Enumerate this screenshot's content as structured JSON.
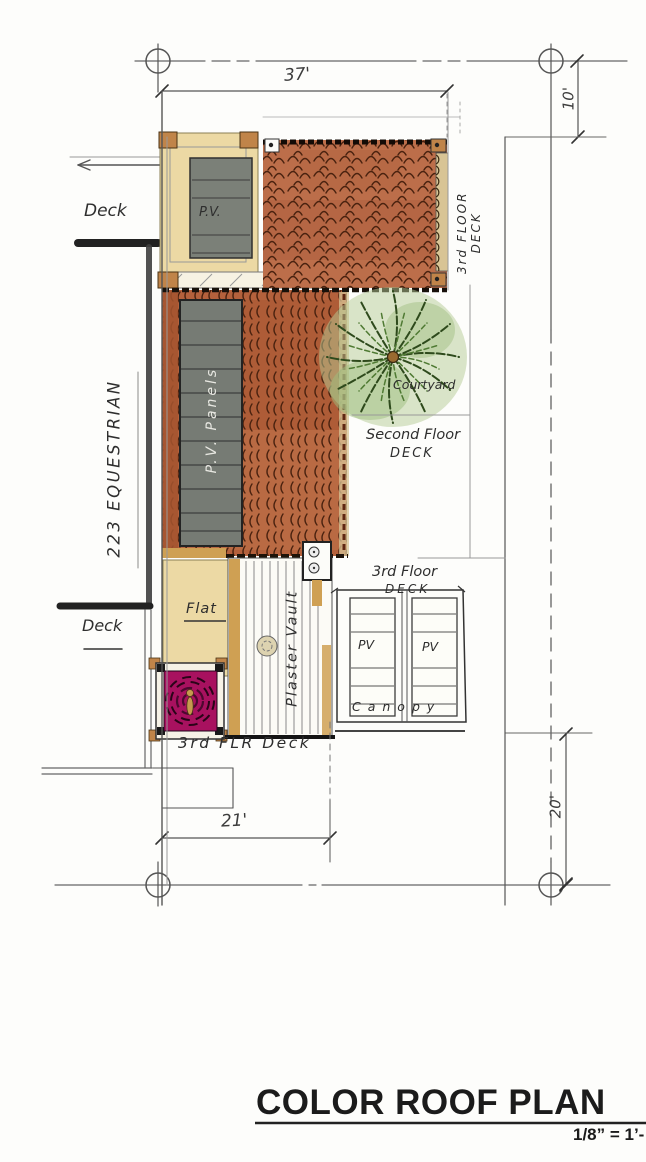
{
  "title_block": {
    "title": "COLOR ROOF PLAN",
    "scale": "1/8” = 1’-"
  },
  "dimensions": {
    "top_width": "37'",
    "right_upper": "10'",
    "bottom_left": "21'",
    "right_lower": "20'"
  },
  "labels": {
    "deck_upper": "Deck",
    "street": "223 EQUESTRIAN",
    "deck_lower": "Deck",
    "pv_small": "P.V.",
    "pv_panels": "P.V. Panels",
    "third_floor_deck_side_line1": "3rd FLOOR",
    "third_floor_deck_side_line2": "DECK",
    "courtyard": "Courtyard",
    "second_floor_line1": "Second Floor",
    "second_floor_line2": "DECK",
    "third_floor_line1": "3rd Floor",
    "third_floor_line2": "DECK",
    "pv_canopy_left": "PV",
    "pv_canopy_right": "PV",
    "canopy": "Canopy",
    "flat": "Flat",
    "plaster_vault": "Plaster Vault",
    "third_flr_deck": "3rd FLR Deck"
  },
  "colors": {
    "paper": "#fdfdfb",
    "tile": "#bc6e4a",
    "tile_stroke": "#5a2612",
    "cream_roof": "#ecd9a4",
    "panel_gray": "#7b8078",
    "corner_tan": "#c08449",
    "palm_green": "#2e4a1c",
    "palm_wash": "#9dbd7d",
    "magenta_feature": "#a8115f",
    "pencil": "#4d4d4d",
    "ink": "#1b1b1b"
  }
}
